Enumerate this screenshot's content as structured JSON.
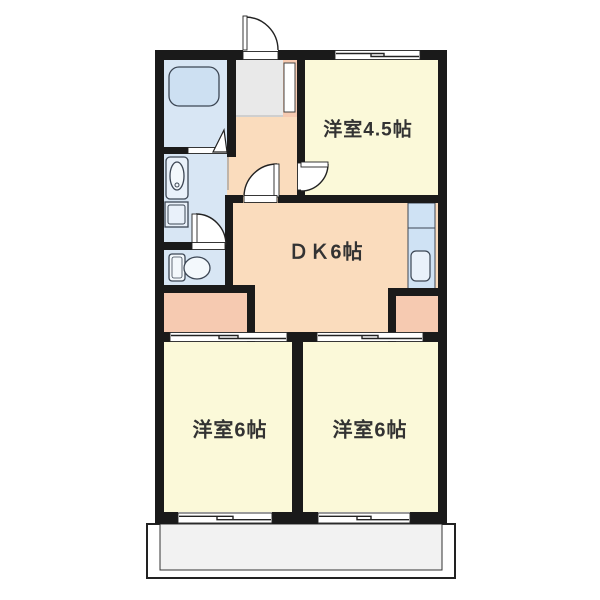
{
  "floorplan": {
    "rooms": {
      "western_45": {
        "label": "洋室4.5帖"
      },
      "dk": {
        "label": "ＤＫ6帖"
      },
      "western_6_left": {
        "label": "洋室6帖"
      },
      "western_6_right": {
        "label": "洋室6帖"
      }
    },
    "colors": {
      "background": "#ffffff",
      "wall": "#1a1a1a",
      "room_yellow": "#fbf9d9",
      "hall_peach": "#fadcbd",
      "closet_pink": "#f6cab1",
      "sanitary_blue": "#d8e6f4",
      "fixture_blue": "#e9f1fa",
      "tub_blue": "#cde0f2",
      "kitchen_blue": "#cfe2f4",
      "genkan_gray": "#e9e9e9",
      "balcony_gray": "#f2f2f2",
      "label_text": "#333333"
    },
    "features": [
      "entrance-door",
      "shoe-cabinet",
      "bathtub",
      "washbasin",
      "washing-machine",
      "toilet",
      "kitchen-counter",
      "kitchen-sink",
      "closet-left",
      "closet-right",
      "balcony",
      "sliding-windows",
      "sliding-doors"
    ]
  }
}
